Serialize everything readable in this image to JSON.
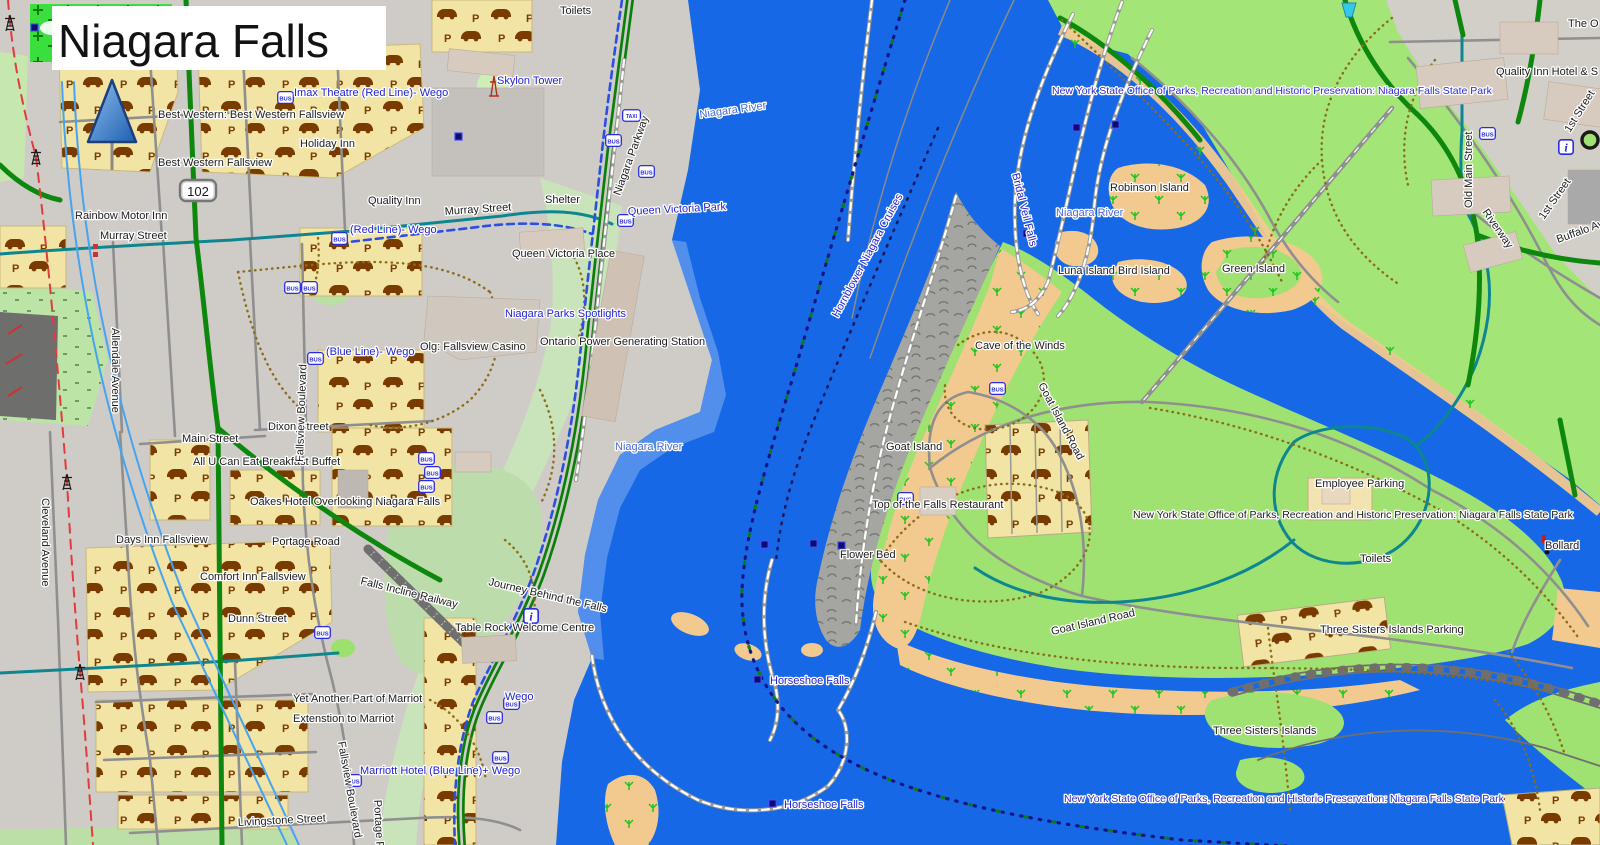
{
  "title": "Niagara Falls",
  "icons": {
    "bus": "BUS",
    "taxi": "TAXI",
    "info": "i",
    "parking": "P"
  },
  "colors": {
    "water": "#1668E6",
    "water_shallow": "#5D97EC",
    "park_green": "#A0E271",
    "pale_green": "#C9E3BA",
    "bright_green": "#3ADF3E",
    "scrub_tan": "#F2C98F",
    "land_gray": "#CFCCC7",
    "road_green": "#0E870E",
    "road_teal": "#0E8690",
    "poi_blue": "#2222D2",
    "border_navy": "#151585"
  },
  "labels": {
    "route_102": "102",
    "imax": "Imax Theatre (Red Line)- Wego",
    "best_western_full": "Best Western: Best Western Fallsview",
    "holiday_inn": "Holiday Inn",
    "best_western": "Best Western Fallsview",
    "quality_inn": "Quality Inn",
    "rainbow_motor": "Rainbow Motor Inn",
    "murray_street": "Murray Street",
    "red_line_wego": "(Red Line)- Wego",
    "skylon": "Skylon Tower",
    "toilets": "Toilets",
    "shelter": "Shelter",
    "queen_victoria_park": "Queen Victoria Park",
    "queen_victoria_place": "Queen Victoria Place",
    "spotlights": "Niagara Parks Spotlights",
    "niagara_parkway": "Niagara Parkway",
    "niagara_river": "Niagara River",
    "blue_line_wego": "(Blue Line)- Wego",
    "olg_casino": "Olg: Fallsview Casino",
    "power_station": "Ontario Power Generating Station",
    "fallsview_blvd": "Fallsview Boulevard",
    "allendale": "Allendale Avenue",
    "main_street": "Main Street",
    "dixon_street": "Dixon Street",
    "breakfast_buffet": "All U Can Eat Breakfast Buffet",
    "oakes_hotel": "Oakes Hotel Overlooking Niagara Falls",
    "days_inn": "Days Inn Fallsview",
    "portage_road": "Portage Road",
    "comfort_inn": "Comfort Inn Fallsview",
    "cleveland_ave": "Cleveland Avenue",
    "dunn_street": "Dunn Street",
    "falls_incline": "Falls Incline Railway",
    "journey_falls": "Journey Behind the Falls",
    "table_rock": "Table Rock Welcome Centre",
    "yet_marriot": "Yet Another Part of Marriot",
    "ext_marriot": "Extenstion to Marriot",
    "wego": "Wego",
    "marriott_wego": "Marriott Hotel (Blue Line)+ Wego",
    "livingstone": "Livingstone Street",
    "horseshoe_falls": "Horseshoe Falls",
    "hornblower": "Hornblower Niagara Cruises",
    "parks_dept": "New York State Office of Parks, Recreation and Historic Preservation: Niagara Falls State Park",
    "quality_inn_hotel": "Quality Inn Hotel & S",
    "the_o": "The O",
    "robinson_island": "Robinson Island",
    "bridal_veil": "Bridal Veil Falls",
    "luna_bird": "Luna Island Bird Island",
    "green_island": "Green Island",
    "cave_winds": "Cave of the Winds",
    "goat_island": "Goat Island",
    "goat_island_road": "Goat Island Road",
    "top_falls_restaurant": "Top of the Falls Restaurant",
    "flower_bed": "Flower Bed",
    "employee_parking": "Employee Parking",
    "bollard": "Bollard",
    "three_sisters_parking": "Three Sisters Islands Parking",
    "three_sisters": "Three Sisters Islands",
    "old_main": "Old Main Street",
    "first_street": "1st Street",
    "riverway": "Riverway",
    "buffalo_ave": "Buffalo Ave"
  }
}
